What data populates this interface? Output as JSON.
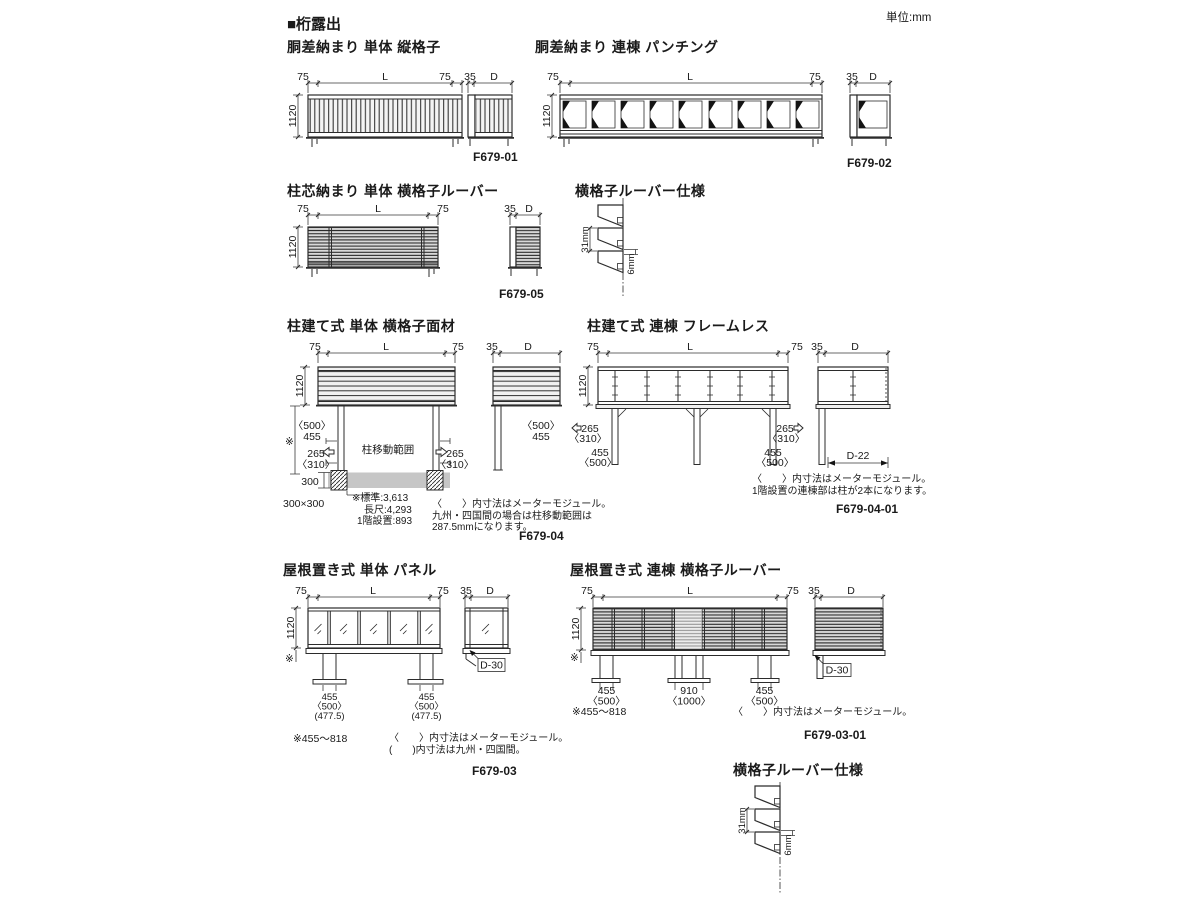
{
  "page": {
    "section_title": "■桁露出",
    "unit_label": "単位:mm"
  },
  "dims": {
    "d75": "75",
    "L": "L",
    "d35": "35",
    "dD": "D",
    "d1120": "1120",
    "d455": "455",
    "d500": "〈500〉",
    "d265": "265",
    "d310": "〈310〉",
    "d300": "300",
    "d300x300": "300×300",
    "d4775": "(477.5)",
    "d910": "910",
    "d1000": "〈1000〉",
    "dD22": "D-22",
    "dD30": "D-30",
    "asterisk": "※",
    "pitch31": "31mm",
    "gap6": "6mm"
  },
  "d01": {
    "title": "胴差納まり 単体 縦格子",
    "code": "F679-01"
  },
  "d02": {
    "title": "胴差納まり 連棟 パンチング",
    "code": "F679-02"
  },
  "d05": {
    "title": "柱芯納まり 単体 横格子ルーバー",
    "code": "F679-05"
  },
  "spec_top": {
    "title": "横格子ルーバー仕様"
  },
  "d04": {
    "title": "柱建て式 単体 横格子面材",
    "code": "F679-04",
    "post_range": "柱移動範囲",
    "note_std": "※標準:3,613",
    "note_long": "長尺:4,293",
    "note_first": "1階設置:893",
    "note1": "〈　　〉内寸法はメーターモジュール。",
    "note2": "九州・四国間の場合は柱移動範囲は",
    "note3": "287.5mmになります。"
  },
  "d04_01": {
    "title": "柱建て式 連棟 フレームレス",
    "code": "F679-04-01",
    "note1": "〈　　〉内寸法はメーターモジュール。",
    "note2": "1階設置の連棟部は柱が2本になります。"
  },
  "d03": {
    "title": "屋根置き式 単体 パネル",
    "code": "F679-03",
    "range": "※455〜818",
    "note1": "〈　　〉内寸法はメーターモジュール。",
    "note2": "(　　)内寸法は九州・四国間。"
  },
  "d03_01": {
    "title": "屋根置き式 連棟 横格子ルーバー",
    "code": "F679-03-01",
    "range": "※455〜818",
    "note1": "〈　　〉内寸法はメーターモジュール。"
  },
  "spec_bottom": {
    "title": "横格子ルーバー仕様"
  }
}
